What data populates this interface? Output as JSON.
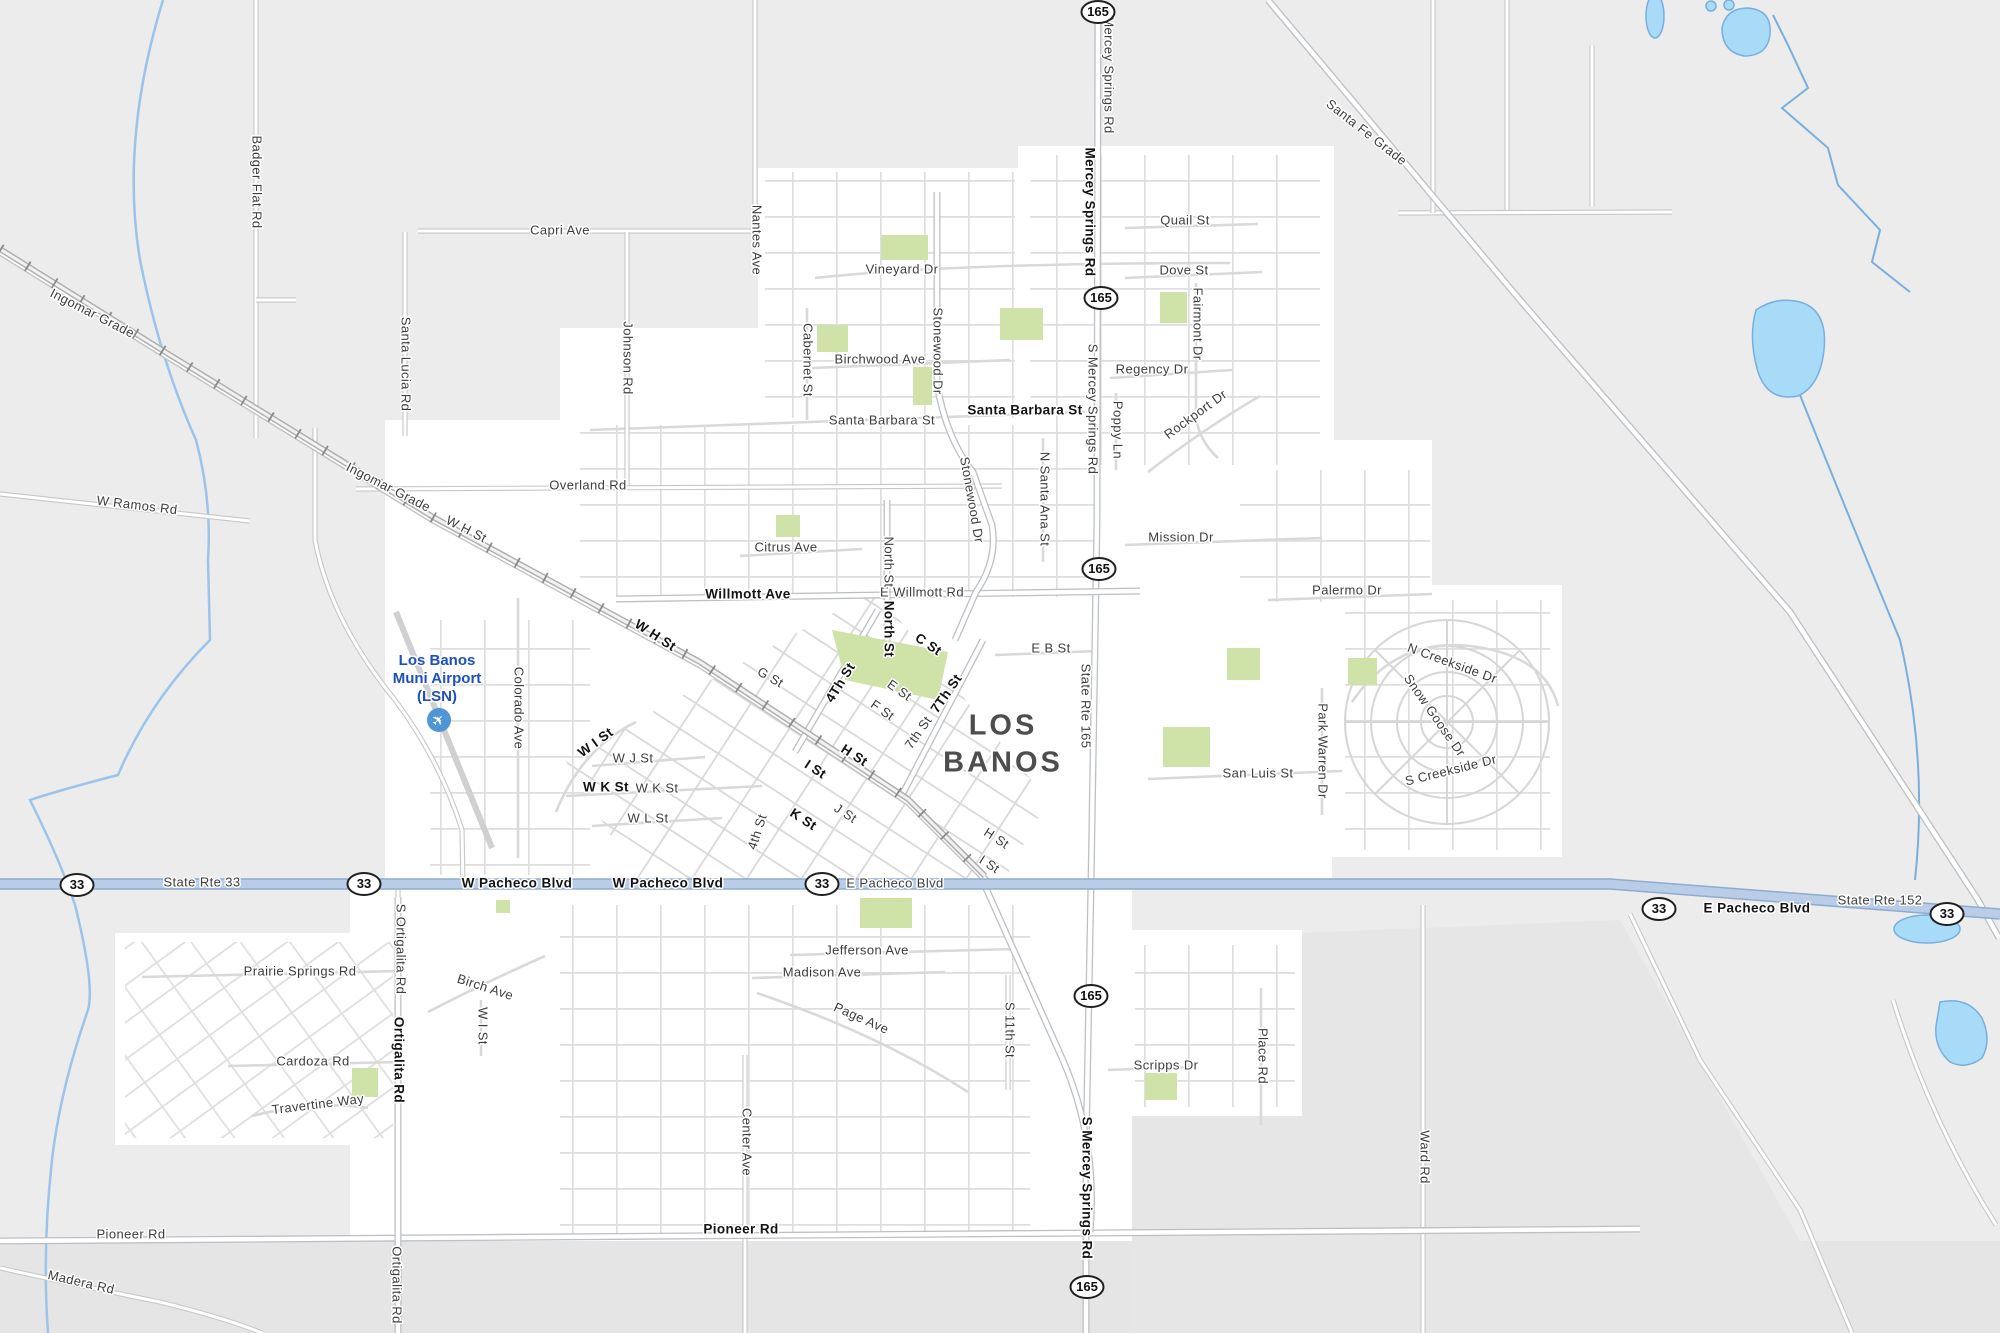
{
  "map": {
    "city_name": {
      "line1": "LOS",
      "line2": "BANOS"
    },
    "airport": {
      "line1": "Los Banos",
      "line2": "Muni Airport",
      "line3": "(LSN)",
      "icon": "airplane-icon",
      "plane_glyph": "✈",
      "label_color": "#1c50c2",
      "icon_color": "#4e96d6"
    },
    "colors": {
      "background": "#ececec",
      "urban": "#ffffff",
      "park": "#cfe3a9",
      "water_fill": "#a8dbf7",
      "water_edge": "#79aede",
      "highway_fill": "#b9cde9",
      "highway_edge": "#8fabce",
      "road_fill": "#ffffff",
      "road_edge": "#c7c7c7",
      "label": "#3d3d3d"
    },
    "shields": {
      "route_165_label": "165",
      "route_33_label": "33",
      "positions_165": [
        [
          1098,
          12
        ],
        [
          1101,
          298
        ],
        [
          1099,
          569
        ],
        [
          1091,
          996
        ],
        [
          1087,
          1287
        ]
      ],
      "positions_33": [
        [
          77,
          885
        ],
        [
          364,
          884
        ],
        [
          822,
          884
        ],
        [
          1659,
          909
        ],
        [
          1947,
          914
        ]
      ]
    },
    "parks": [
      [
        881,
        235,
        47,
        25
      ],
      [
        817,
        325,
        31,
        27
      ],
      [
        913,
        367,
        19,
        38
      ],
      [
        1000,
        308,
        43,
        32
      ],
      [
        1160,
        292,
        27,
        31
      ],
      [
        1227,
        648,
        33,
        32
      ],
      [
        1163,
        727,
        47,
        40
      ],
      [
        860,
        898,
        52,
        30
      ],
      [
        1145,
        1073,
        32,
        27
      ],
      [
        352,
        1068,
        26,
        29
      ],
      [
        776,
        515,
        24,
        22
      ],
      [
        1348,
        658,
        29,
        27
      ],
      [
        496,
        900,
        14,
        13
      ]
    ],
    "downtown_park_points": "832,630 948,652 938,700 845,680",
    "labels": [
      {
        "t": "Badger Flat Rd",
        "x": 256,
        "y": 182,
        "r": 90
      },
      {
        "t": "Ingomar Grade",
        "x": 92,
        "y": 314,
        "r": 27
      },
      {
        "t": "Ingomar Grade",
        "x": 388,
        "y": 488,
        "r": 27
      },
      {
        "t": "W H St",
        "x": 466,
        "y": 530,
        "r": 27
      },
      {
        "t": "W H St",
        "x": 655,
        "y": 636,
        "r": 33,
        "b": 1
      },
      {
        "t": "W Ramos Rd",
        "x": 137,
        "y": 506,
        "r": 7
      },
      {
        "t": "Capri Ave",
        "x": 560,
        "y": 231
      },
      {
        "t": "Santa Lucia Rd",
        "x": 405,
        "y": 364,
        "r": 90
      },
      {
        "t": "Johnson Rd",
        "x": 627,
        "y": 358,
        "r": 90
      },
      {
        "t": "Nantes Ave",
        "x": 756,
        "y": 240,
        "r": 90
      },
      {
        "t": "Overland Rd",
        "x": 588,
        "y": 486
      },
      {
        "t": "Vineyard Dr",
        "x": 902,
        "y": 270
      },
      {
        "t": "Birchwood Ave",
        "x": 880,
        "y": 360
      },
      {
        "t": "Cabernet St",
        "x": 807,
        "y": 360,
        "r": 90
      },
      {
        "t": "Stonewood Dr",
        "x": 937,
        "y": 351,
        "r": 90
      },
      {
        "t": "Stonewood Dr",
        "x": 971,
        "y": 500,
        "r": 80
      },
      {
        "t": "Santa Barbara St",
        "x": 1025,
        "y": 411,
        "b": 1
      },
      {
        "t": "Santa Barbara St",
        "x": 882,
        "y": 421
      },
      {
        "t": "Mercey Springs Rd",
        "x": 1108,
        "y": 75,
        "r": 90
      },
      {
        "t": "Mercey Springs Rd",
        "x": 1089,
        "y": 212,
        "r": 90,
        "b": 1
      },
      {
        "t": "Quail St",
        "x": 1185,
        "y": 221
      },
      {
        "t": "Dove St",
        "x": 1184,
        "y": 271
      },
      {
        "t": "Fairmont Dr",
        "x": 1197,
        "y": 324,
        "r": 90
      },
      {
        "t": "Regency Dr",
        "x": 1152,
        "y": 370
      },
      {
        "t": "Rockport Dr",
        "x": 1196,
        "y": 415,
        "r": -36
      },
      {
        "t": "Poppy Ln",
        "x": 1117,
        "y": 430,
        "r": 90
      },
      {
        "t": "S Mercey Springs Rd",
        "x": 1092,
        "y": 409,
        "r": 90
      },
      {
        "t": "N Santa Ana St",
        "x": 1044,
        "y": 499,
        "r": 90
      },
      {
        "t": "Mission Dr",
        "x": 1181,
        "y": 538
      },
      {
        "t": "Palermo Dr",
        "x": 1347,
        "y": 591
      },
      {
        "t": "E Willmott Rd",
        "x": 922,
        "y": 593
      },
      {
        "t": "Willmott Ave",
        "x": 748,
        "y": 595,
        "b": 1
      },
      {
        "t": "Citrus Ave",
        "x": 786,
        "y": 548
      },
      {
        "t": "North St",
        "x": 888,
        "y": 562,
        "r": 90
      },
      {
        "t": "North St",
        "x": 888,
        "y": 629,
        "r": 90,
        "b": 1
      },
      {
        "t": "C St",
        "x": 928,
        "y": 645,
        "r": 34,
        "b": 1
      },
      {
        "t": "G St",
        "x": 770,
        "y": 678,
        "r": 30
      },
      {
        "t": "4Th St",
        "x": 841,
        "y": 683,
        "r": -58,
        "b": 1
      },
      {
        "t": "E St",
        "x": 899,
        "y": 691,
        "r": 35
      },
      {
        "t": "F St",
        "x": 882,
        "y": 711,
        "r": 35
      },
      {
        "t": "7Th St",
        "x": 947,
        "y": 694,
        "r": -55,
        "b": 1
      },
      {
        "t": "7th St",
        "x": 919,
        "y": 733,
        "r": -55
      },
      {
        "t": "E B St",
        "x": 1051,
        "y": 649
      },
      {
        "t": "State Rte 165",
        "x": 1085,
        "y": 706,
        "r": 90
      },
      {
        "t": "H St",
        "x": 854,
        "y": 756,
        "r": 33,
        "b": 1
      },
      {
        "t": "I St",
        "x": 815,
        "y": 770,
        "r": 33,
        "b": 1
      },
      {
        "t": "W I St",
        "x": 596,
        "y": 743,
        "r": -36,
        "b": 1
      },
      {
        "t": "W J St",
        "x": 633,
        "y": 759
      },
      {
        "t": "W K St",
        "x": 606,
        "y": 788,
        "b": 1
      },
      {
        "t": "W K St",
        "x": 657,
        "y": 789
      },
      {
        "t": "W L St",
        "x": 648,
        "y": 819
      },
      {
        "t": "4th St",
        "x": 758,
        "y": 832,
        "r": -72
      },
      {
        "t": "K St",
        "x": 803,
        "y": 820,
        "r": 33,
        "b": 1
      },
      {
        "t": "J St",
        "x": 845,
        "y": 814,
        "r": 33
      },
      {
        "t": "H St",
        "x": 996,
        "y": 839,
        "r": 33
      },
      {
        "t": "I St",
        "x": 989,
        "y": 865,
        "r": 33
      },
      {
        "t": "San Luis St",
        "x": 1258,
        "y": 774
      },
      {
        "t": "Park Warren Dr",
        "x": 1322,
        "y": 751,
        "r": 90
      },
      {
        "t": "N Creekside Dr",
        "x": 1452,
        "y": 664,
        "r": 20
      },
      {
        "t": "Snow Goose Dr",
        "x": 1434,
        "y": 716,
        "r": 55
      },
      {
        "t": "S Creekside Dr",
        "x": 1451,
        "y": 771,
        "r": -14
      },
      {
        "t": "Colorado Ave",
        "x": 518,
        "y": 708,
        "r": 90
      },
      {
        "t": "State Rte 33",
        "x": 202,
        "y": 883
      },
      {
        "t": "W Pacheco Blvd",
        "x": 517,
        "y": 884,
        "b": 1
      },
      {
        "t": "W Pacheco Blvd",
        "x": 668,
        "y": 884,
        "b": 1
      },
      {
        "t": "E Pacheco Blvd",
        "x": 895,
        "y": 884
      },
      {
        "t": "E Pacheco Blvd",
        "x": 1757,
        "y": 909,
        "b": 1
      },
      {
        "t": "State Rte 152",
        "x": 1880,
        "y": 901
      },
      {
        "t": "Santa Fe Grade",
        "x": 1366,
        "y": 133,
        "r": 38
      },
      {
        "t": "Jefferson Ave",
        "x": 867,
        "y": 951
      },
      {
        "t": "Madison Ave",
        "x": 822,
        "y": 973
      },
      {
        "t": "Page Ave",
        "x": 861,
        "y": 1019,
        "r": 24
      },
      {
        "t": "Center Ave",
        "x": 746,
        "y": 1142,
        "r": 90
      },
      {
        "t": "S 11th St",
        "x": 1009,
        "y": 1030,
        "r": 90
      },
      {
        "t": "S Mercey Springs Rd",
        "x": 1086,
        "y": 1188,
        "r": 90,
        "b": 1
      },
      {
        "t": "Scripps Dr",
        "x": 1166,
        "y": 1066
      },
      {
        "t": "Place Rd",
        "x": 1262,
        "y": 1056,
        "r": 90
      },
      {
        "t": "Ward Rd",
        "x": 1424,
        "y": 1157,
        "r": 90
      },
      {
        "t": "Pioneer Rd",
        "x": 741,
        "y": 1230,
        "b": 1
      },
      {
        "t": "Pioneer Rd",
        "x": 131,
        "y": 1235
      },
      {
        "t": "Madera Rd",
        "x": 81,
        "y": 1283,
        "r": 13
      },
      {
        "t": "Prairie Springs Rd",
        "x": 300,
        "y": 972
      },
      {
        "t": "Cardoza Rd",
        "x": 313,
        "y": 1062
      },
      {
        "t": "Travertine Way",
        "x": 318,
        "y": 1105,
        "r": -7
      },
      {
        "t": "Ortigalita Rd",
        "x": 398,
        "y": 1060,
        "r": 90,
        "b": 1
      },
      {
        "t": "S Ortigalita Rd",
        "x": 400,
        "y": 949,
        "r": 90
      },
      {
        "t": "Ortigalita Rd",
        "x": 396,
        "y": 1285,
        "r": 90
      },
      {
        "t": "Birch Ave",
        "x": 485,
        "y": 988,
        "r": 18
      },
      {
        "t": "W I St",
        "x": 482,
        "y": 1026,
        "r": 90
      }
    ]
  }
}
